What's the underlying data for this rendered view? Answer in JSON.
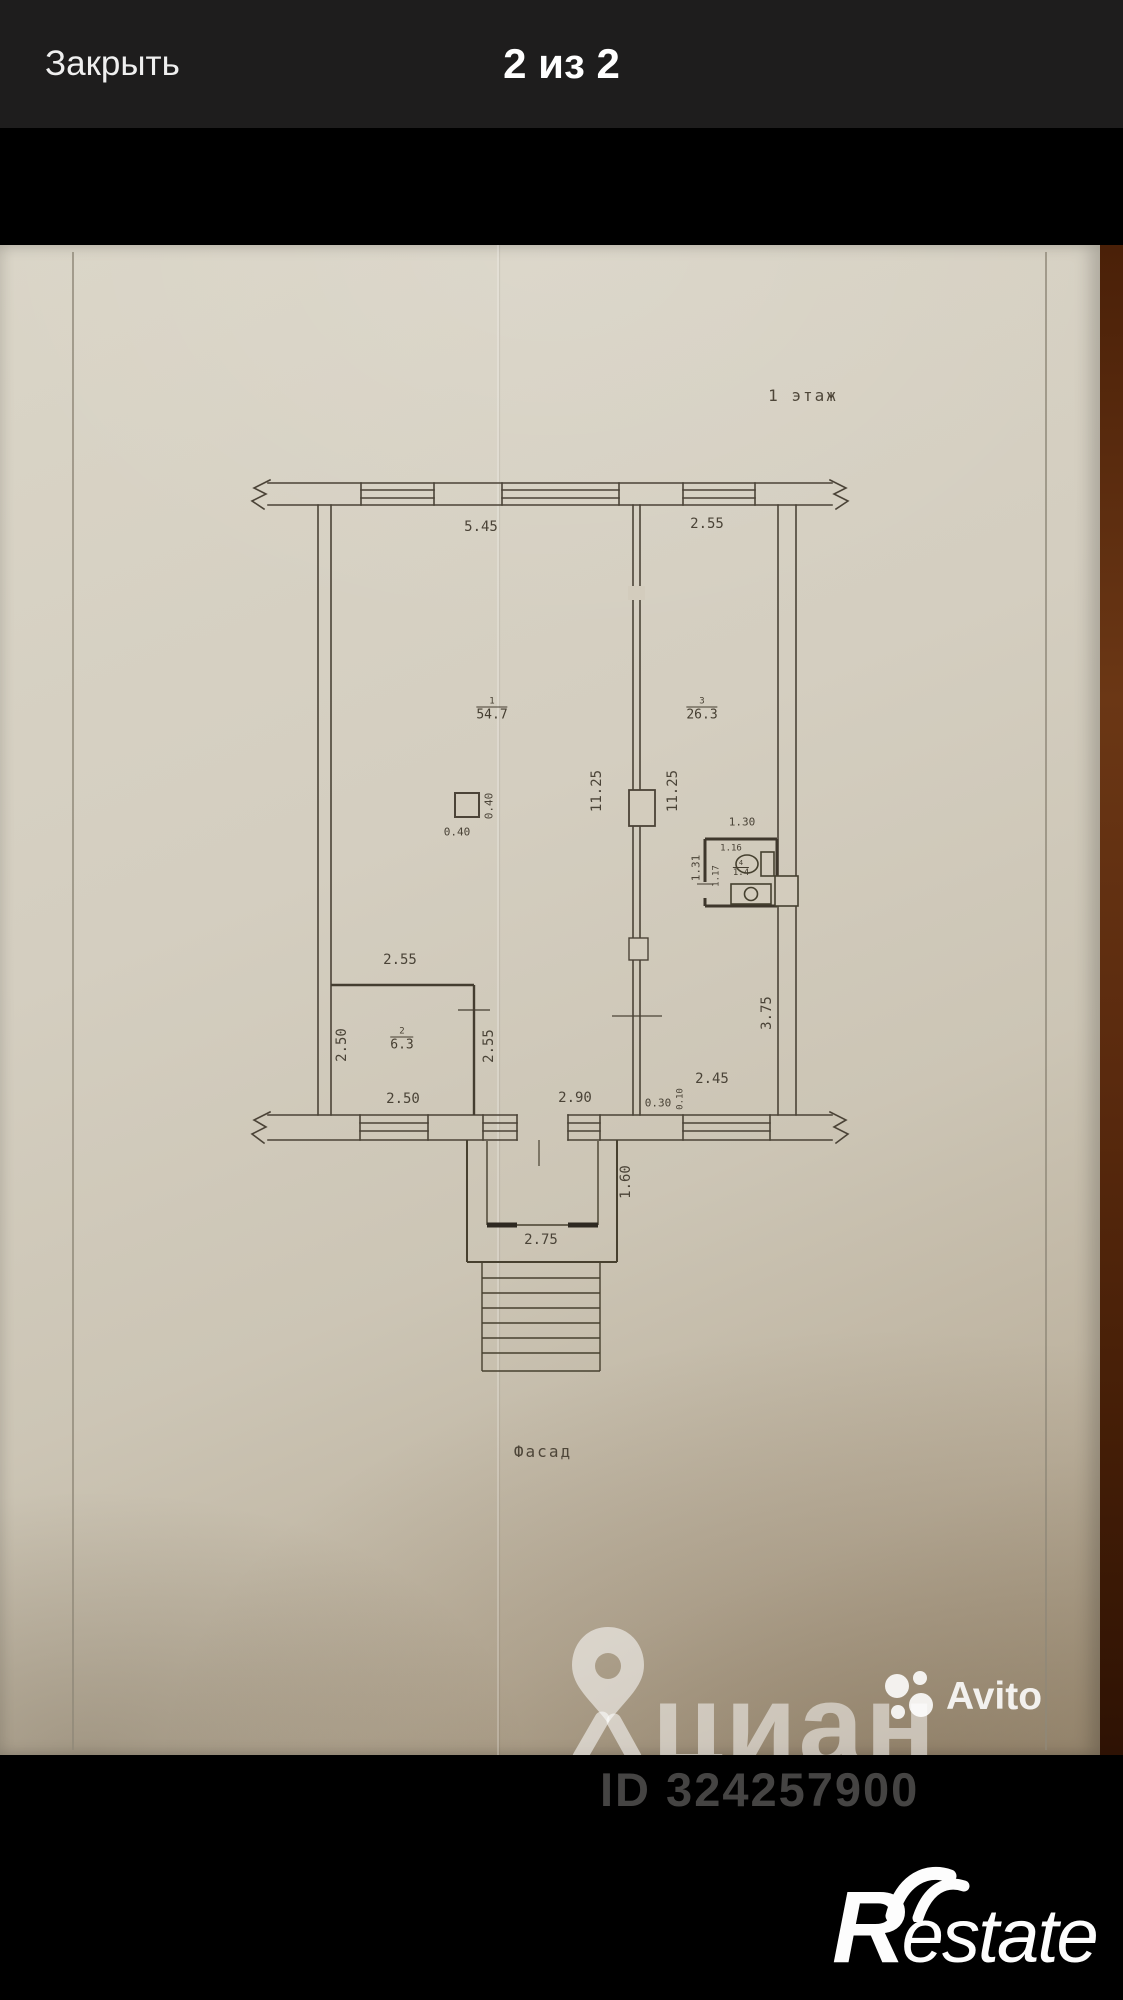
{
  "topbar": {
    "close_label": "Закрыть",
    "counter": "2 из 2"
  },
  "photo": {
    "floor_label": "1 этаж",
    "facade_label": "Фасад",
    "rooms": [
      {
        "num": "1",
        "area": "54.7"
      },
      {
        "num": "3",
        "area": "26.3"
      },
      {
        "num": "2",
        "area": "6.3"
      },
      {
        "num": "4",
        "area": "1.4"
      }
    ],
    "dims": [
      {
        "text": "5.45"
      },
      {
        "text": "2.55"
      },
      {
        "text": "11.25"
      },
      {
        "text": "11.25"
      },
      {
        "text": "0.40"
      },
      {
        "text": "0.40"
      },
      {
        "text": "1.30"
      },
      {
        "text": "1.31"
      },
      {
        "text": "1.16"
      },
      {
        "text": "1.17"
      },
      {
        "text": "2.55"
      },
      {
        "text": "2.50"
      },
      {
        "text": "2.55"
      },
      {
        "text": "2.50"
      },
      {
        "text": "2.90"
      },
      {
        "text": "0.30"
      },
      {
        "text": "0.10"
      },
      {
        "text": "2.45"
      },
      {
        "text": "3.75"
      },
      {
        "text": "1.60"
      },
      {
        "text": "2.75"
      }
    ],
    "watermarks": {
      "cian_text": "циан",
      "avito_text": "Avito",
      "listing_id": "ID 324257900"
    }
  },
  "footer": {
    "restate_initial": "R",
    "restate_rest": "estate"
  },
  "icons": {
    "cian_pin": "map-pin",
    "avito_dots": "four-dots",
    "restate_swoosh": "double-arc"
  },
  "colors": {
    "topbar_bg": "#1e1d1d",
    "paper": "#d3cdbf",
    "plan_line": "#4b4337",
    "wood_background": "#5a2a0e",
    "watermark_white": "rgba(255,255,255,0.5)"
  }
}
